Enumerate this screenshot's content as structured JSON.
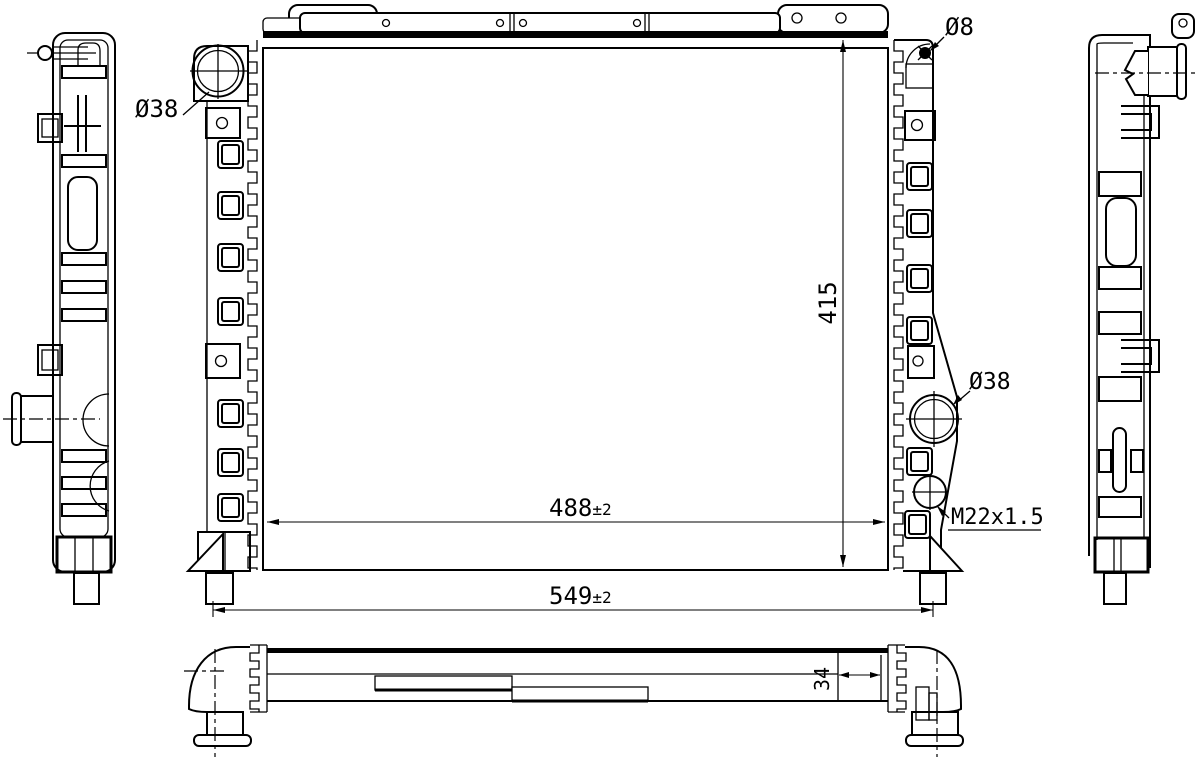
{
  "drawing": {
    "kind": "radiator engineering drawing"
  },
  "dimensions": {
    "height": "415",
    "core_width": "488",
    "core_width_tol": "±2",
    "overall_width": "549",
    "overall_width_tol": "±2",
    "pipe_section": "34",
    "inlet_diameter": "Ø38",
    "outlet_diameter": "Ø38",
    "pin_diameter": "Ø8",
    "drain_thread": "M22x1.5"
  },
  "colors": {
    "line": "#000000",
    "background": "#ffffff"
  }
}
